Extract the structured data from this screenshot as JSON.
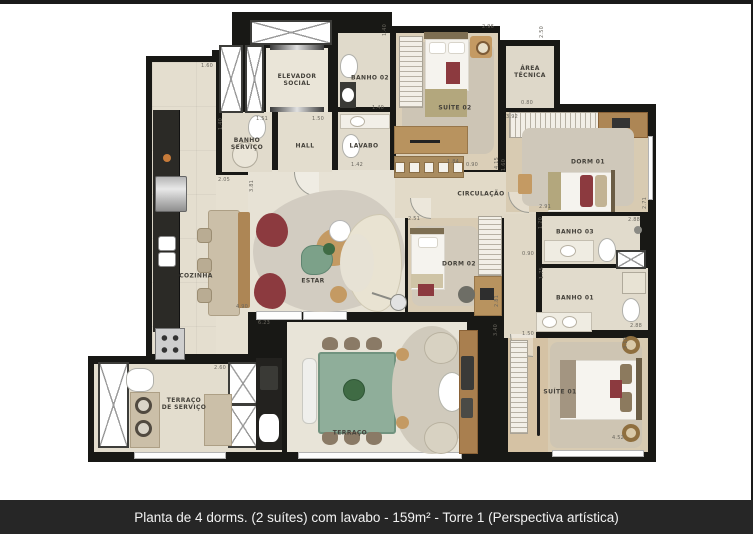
{
  "caption": {
    "text": "Planta de 4 dorms. (2 suítes) com lavabo - 159m² - Torre 1 (Perspectiva artística)"
  },
  "plan": {
    "rooms": [
      {
        "id": "elevador-social",
        "label": "ELEVADOR\nSOCIAL",
        "x": 297,
        "y": 80
      },
      {
        "id": "banho-servico",
        "label": "BANHO\nSERVIÇO",
        "x": 247,
        "y": 144
      },
      {
        "id": "hall",
        "label": "HALL",
        "x": 305,
        "y": 146
      },
      {
        "id": "lavabo",
        "label": "LAVABO",
        "x": 364,
        "y": 146
      },
      {
        "id": "banho-02",
        "label": "BANHO 02",
        "x": 370,
        "y": 78
      },
      {
        "id": "suite-02",
        "label": "SUÍTE 02",
        "x": 455,
        "y": 108
      },
      {
        "id": "area-tecnica",
        "label": "ÁREA\nTÉCNICA",
        "x": 530,
        "y": 72
      },
      {
        "id": "dorm-01",
        "label": "DORM 01",
        "x": 588,
        "y": 162
      },
      {
        "id": "banho-03",
        "label": "BANHO 03",
        "x": 575,
        "y": 232
      },
      {
        "id": "banho-01",
        "label": "BANHO 01",
        "x": 575,
        "y": 298
      },
      {
        "id": "circulacao",
        "label": "CIRCULAÇÃO",
        "x": 481,
        "y": 194
      },
      {
        "id": "dorm-02",
        "label": "DORM 02",
        "x": 459,
        "y": 264
      },
      {
        "id": "cozinha",
        "label": "COZINHA",
        "x": 196,
        "y": 276
      },
      {
        "id": "estar",
        "label": "ESTAR",
        "x": 313,
        "y": 281
      },
      {
        "id": "terraco",
        "label": "TERRAÇO",
        "x": 350,
        "y": 433
      },
      {
        "id": "terraco-servico",
        "label": "TERRAÇO\nDE SERVIÇO",
        "x": 184,
        "y": 404
      },
      {
        "id": "suite-01",
        "label": "SUÍTE 01",
        "x": 560,
        "y": 392
      }
    ],
    "dimensions": [
      {
        "text": "1.60",
        "x": 207,
        "y": 66,
        "o": "h"
      },
      {
        "text": "2.05",
        "x": 224,
        "y": 180,
        "o": "h"
      },
      {
        "text": "1.51",
        "x": 262,
        "y": 119,
        "o": "h"
      },
      {
        "text": "1.40",
        "x": 221,
        "y": 124,
        "o": "v"
      },
      {
        "text": "1.50",
        "x": 318,
        "y": 119,
        "o": "h"
      },
      {
        "text": "1.40",
        "x": 385,
        "y": 30,
        "o": "v"
      },
      {
        "text": "1.40",
        "x": 378,
        "y": 108,
        "o": "h"
      },
      {
        "text": "1.42",
        "x": 357,
        "y": 165,
        "o": "h"
      },
      {
        "text": "2.96",
        "x": 488,
        "y": 27,
        "o": "h"
      },
      {
        "text": "2.50",
        "x": 542,
        "y": 32,
        "o": "v"
      },
      {
        "text": "0.80",
        "x": 527,
        "y": 103,
        "o": "h"
      },
      {
        "text": "3.92",
        "x": 512,
        "y": 117,
        "o": "h"
      },
      {
        "text": "1.60",
        "x": 504,
        "y": 165,
        "o": "v"
      },
      {
        "text": "2.91",
        "x": 545,
        "y": 207,
        "o": "h"
      },
      {
        "text": "2.71",
        "x": 645,
        "y": 203,
        "o": "v"
      },
      {
        "text": "2.88",
        "x": 634,
        "y": 220,
        "o": "h"
      },
      {
        "text": "1.20",
        "x": 541,
        "y": 223,
        "o": "v"
      },
      {
        "text": "0.90",
        "x": 528,
        "y": 254,
        "o": "h"
      },
      {
        "text": "1.75",
        "x": 542,
        "y": 273,
        "o": "v"
      },
      {
        "text": "1.84",
        "x": 453,
        "y": 162,
        "o": "h"
      },
      {
        "text": "0.90",
        "x": 472,
        "y": 165,
        "o": "h"
      },
      {
        "text": "4.15",
        "x": 497,
        "y": 163,
        "o": "v"
      },
      {
        "text": "2.51",
        "x": 414,
        "y": 219,
        "o": "h"
      },
      {
        "text": "2.81",
        "x": 497,
        "y": 301,
        "o": "v"
      },
      {
        "text": "3.40",
        "x": 496,
        "y": 330,
        "o": "v"
      },
      {
        "text": "1.50",
        "x": 528,
        "y": 334,
        "o": "h"
      },
      {
        "text": "6.23",
        "x": 264,
        "y": 323,
        "o": "h"
      },
      {
        "text": "4.90",
        "x": 242,
        "y": 307,
        "o": "h"
      },
      {
        "text": "3.81",
        "x": 252,
        "y": 186,
        "o": "v"
      },
      {
        "text": "2.60",
        "x": 220,
        "y": 368,
        "o": "h"
      },
      {
        "text": "3.10",
        "x": 626,
        "y": 343,
        "o": "v"
      },
      {
        "text": "4.52",
        "x": 618,
        "y": 438,
        "o": "h"
      },
      {
        "text": "2.88",
        "x": 636,
        "y": 326,
        "o": "h"
      }
    ],
    "colors": {
      "wall": "#181815",
      "floor": "#e4decf",
      "rug": "#d2ccc1",
      "accent_chair": "#8c3a3f",
      "table_green": "#8fae9a",
      "wood": "#b8935f",
      "caption_bg": "#262626",
      "caption_text": "#f2f2f2"
    }
  }
}
